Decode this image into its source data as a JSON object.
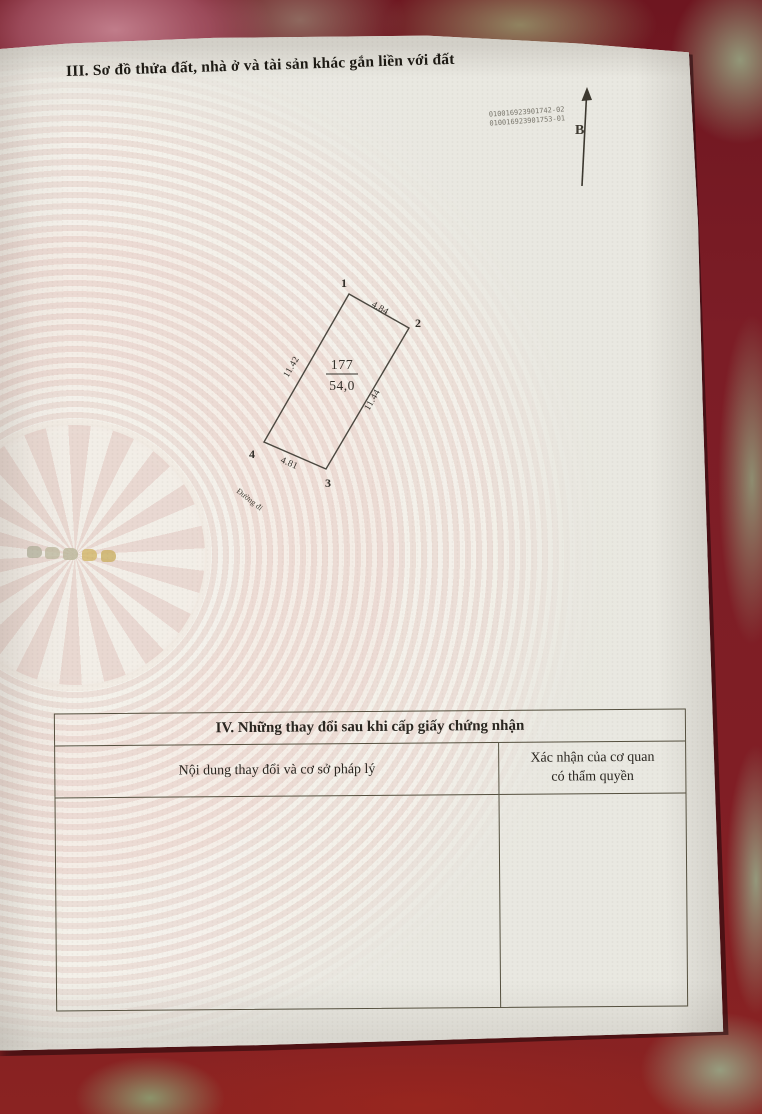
{
  "page": {
    "section3_title": "III. Sơ đồ thửa đất, nhà ở và tài sản khác gắn liền với đất",
    "serial_line1": "010016923901742-02",
    "serial_line2": "010016923901753-01",
    "north_label": "B"
  },
  "parcel": {
    "number": "177",
    "area": "54,0",
    "corners": [
      "1",
      "2",
      "3",
      "4"
    ],
    "edge_top": "4.84",
    "edge_right": "11.44",
    "edge_bottom": "4.81",
    "edge_left": "11.42",
    "road_label": "Đường đi"
  },
  "section4": {
    "title": "IV. Những thay đổi sau khi cấp giấy chứng nhận",
    "col1_header": "Nội dung thay đổi và cơ sở pháp lý",
    "col2_header_line1": "Xác nhận của cơ quan",
    "col2_header_line2": "có thẩm quyền"
  },
  "colors": {
    "fabric_red": "#7c1d26",
    "paper": "#e9e8e1",
    "watermark_pink": "#ecdad3",
    "line": "#55503f",
    "gold_mark": "#c9b273"
  }
}
